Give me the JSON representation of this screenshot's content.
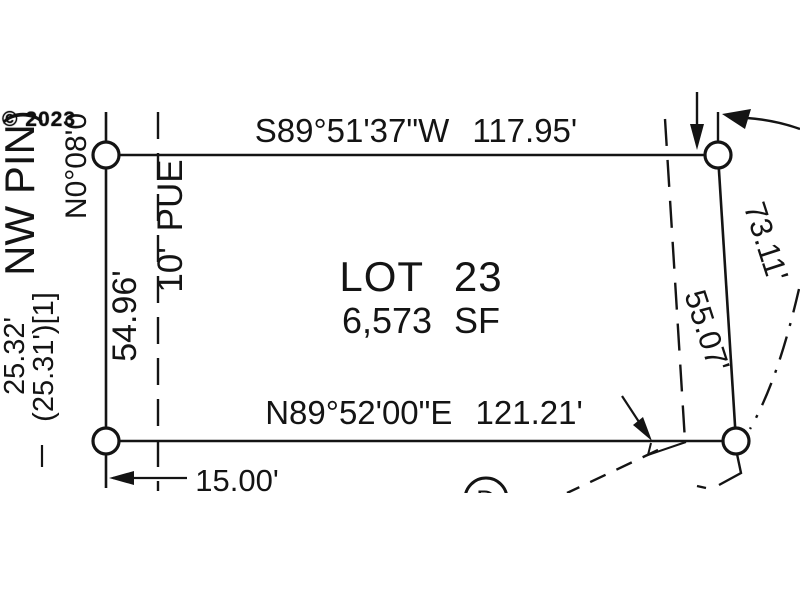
{
  "watermark": "© 2023",
  "lot": {
    "title": "LOT 23",
    "area": "6,573 SF"
  },
  "bearings": {
    "north_line": "S89°51'37\"W 117.95'",
    "south_line": "N89°52'00\"E 121.21'",
    "west_line_partial": "N0°08'0"
  },
  "dimensions": {
    "east_line": "73.11'",
    "east_easement": "55.07'",
    "west_side": "54.96'",
    "west_outer": "25.32'",
    "west_outer_record": "(25.31')[1]",
    "south_offset": "15.00'"
  },
  "annotations": {
    "corner_label": "NW PIN)",
    "easement_label": "10' PUE",
    "deed_symbol": "D"
  },
  "colors": {
    "ink": "#141414",
    "background": "#ffffff"
  }
}
